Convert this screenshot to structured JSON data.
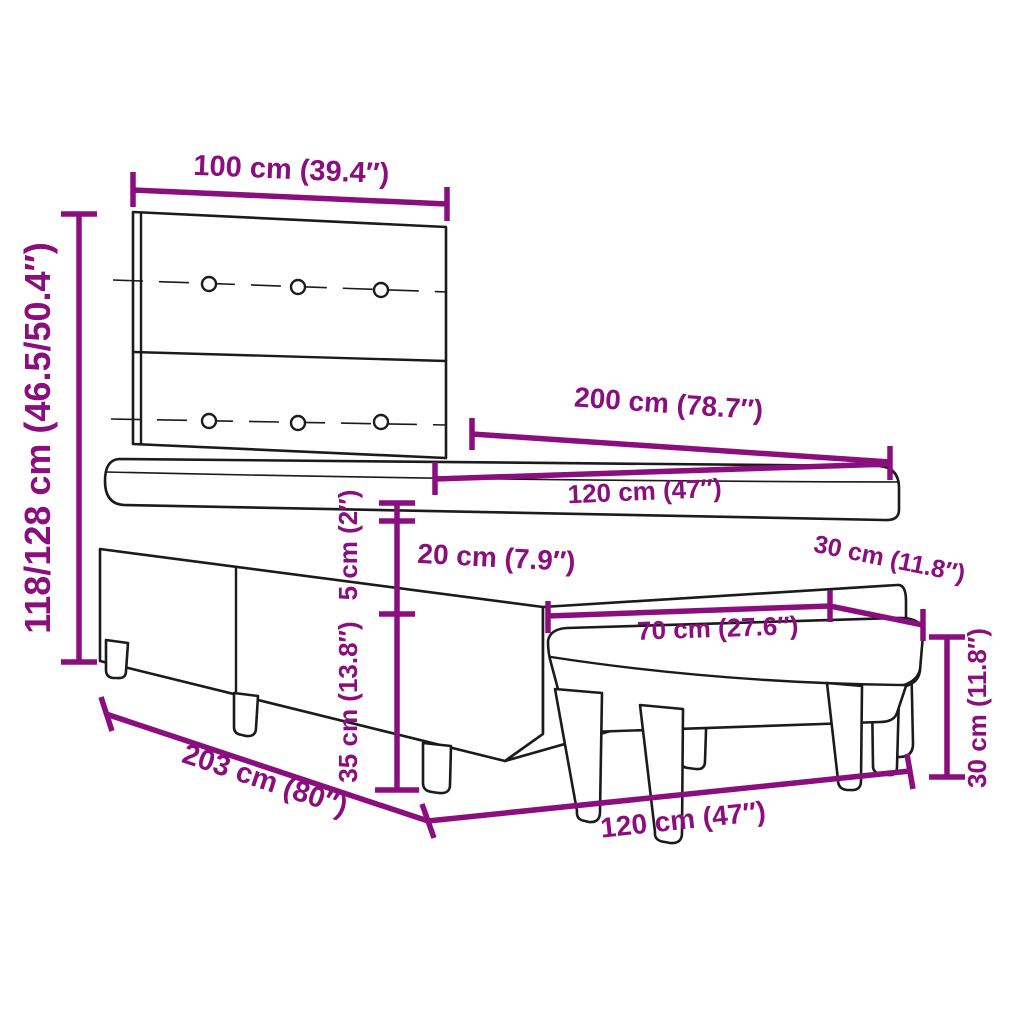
{
  "diagram": {
    "colors": {
      "dimension_accent": "#8B0E7E",
      "line_art": "#1b1b1b",
      "background": "#ffffff"
    },
    "labels": {
      "headboard_width": "100 cm (39.4″)",
      "overall_height": "118/128 cm (46.5/50.4″)",
      "bed_length": "200 cm (78.7″)",
      "mattress_width": "120 cm (47″)",
      "pillow_top_thickness": "5 cm (2″)",
      "mattress_thickness": "20 cm (7.9″)",
      "base_height": "35 cm (13.8″)",
      "base_length": "203 cm (80″)",
      "bench_seat_depth": "30 cm (11.8″)",
      "bench_seat_length": "70 cm (27.6″)",
      "bench_width": "120 cm (47″)",
      "bench_height": "30 cm (11.8″)"
    }
  }
}
